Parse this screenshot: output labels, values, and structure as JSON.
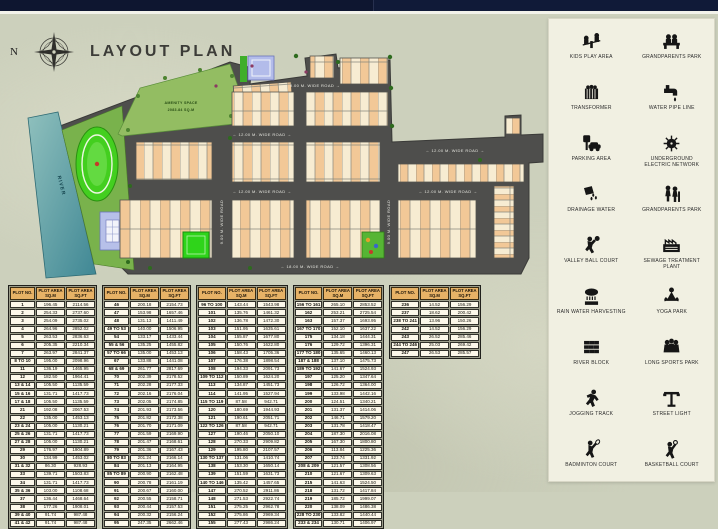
{
  "title": "LAYOUT PLAN",
  "compass": {
    "north_label": "N"
  },
  "map": {
    "labels": {
      "river": "RIVER",
      "amenity_line1": "AMENITY SPACE",
      "amenity_line2": "2083.84 SQ.M"
    },
    "road_labels": [
      "← 9.00 M. WIDE ROAD →",
      "← 12.00 M. WIDE ROAD →",
      "← 12.00 M. WIDE ROAD →",
      "← 12.00 M. WIDE ROAD →",
      "← 12.00 M. WIDE ROAD →",
      "← 18.00 M. WIDE ROAD →",
      "9.00 M. WIDE ROAD",
      "9.00 M. WIDE ROAD"
    ],
    "colors": {
      "road": "#4e4e4c",
      "plot_peach": "#f2c897",
      "plot_cream": "#f7ecd2",
      "park_green": "#79b24c",
      "track_green": "#43cf1f",
      "river_teal": "#5fa3ab",
      "building_blue": "#b7c0e9"
    }
  },
  "tables": {
    "headers": [
      "PLOT NO.",
      "PLOT AREA SQ.M",
      "PLOT AREA SQ.FT"
    ],
    "list": [
      {
        "rows": [
          [
            "1",
            "196.45",
            "2114.56"
          ],
          [
            "2",
            "254.33",
            "2737.60"
          ],
          [
            "3",
            "254.09",
            "2735.02"
          ],
          [
            "4",
            "264.96",
            "2852.02"
          ],
          [
            "5",
            "263.53",
            "2836.63"
          ],
          [
            "6",
            "205.35",
            "2210.34"
          ],
          [
            "7",
            "263.97",
            "2841.37"
          ],
          [
            "8 TO 10",
            "195.00",
            "2098.96"
          ],
          [
            "11",
            "136.19",
            "1465.95"
          ],
          [
            "12",
            "182.50",
            "1964.41"
          ],
          [
            "13 & 14",
            "105.50",
            "1135.59"
          ],
          [
            "15 & 16",
            "131.71",
            "1417.73"
          ],
          [
            "17 & 18",
            "105.50",
            "1135.59"
          ],
          [
            "21",
            "192.08",
            "2067.53"
          ],
          [
            "22",
            "135.00",
            "1453.13"
          ],
          [
            "23 & 24",
            "105.00",
            "1130.21"
          ],
          [
            "25 & 26",
            "131.71",
            "1417.73"
          ],
          [
            "27 & 28",
            "105.00",
            "1130.21"
          ],
          [
            "29",
            "176.97",
            "1904.89"
          ],
          [
            "30",
            "134.99",
            "1453.02"
          ],
          [
            "31 & 32",
            "86.30",
            "928.93"
          ],
          [
            "33",
            "139.71",
            "1503.83"
          ],
          [
            "34",
            "131.71",
            "1417.73"
          ],
          [
            "35 & 36",
            "103.00",
            "1108.68"
          ],
          [
            "37",
            "136.44",
            "1468.64"
          ],
          [
            "38",
            "177.26",
            "1908.01"
          ],
          [
            "39 & 40",
            "91.74",
            "987.48"
          ],
          [
            "41 & 42",
            "91.74",
            "987.48"
          ]
        ]
      },
      {
        "rows": [
          [
            "46",
            "200.18",
            "2154.73"
          ],
          [
            "47",
            "153.98",
            "1657.46"
          ],
          [
            "48",
            "131.13",
            "1411.49"
          ],
          [
            "49 TO 53",
            "140.00",
            "1506.95"
          ],
          [
            "54",
            "133.17",
            "1433.44"
          ],
          [
            "55 & 56",
            "135.25",
            "1455.82"
          ],
          [
            "57 TO 66",
            "135.00",
            "1453.13"
          ],
          [
            "67",
            "133.88",
            "1441.08"
          ],
          [
            "68 & 69",
            "261.77",
            "2817.69"
          ],
          [
            "70",
            "202.39",
            "2178.52"
          ],
          [
            "71",
            "202.28",
            "2177.33"
          ],
          [
            "72",
            "202.16",
            "2176.04"
          ],
          [
            "73",
            "202.05",
            "2174.85"
          ],
          [
            "74",
            "201.93",
            "2173.56"
          ],
          [
            "75",
            "201.82",
            "2172.38"
          ],
          [
            "76",
            "201.70",
            "2171.09"
          ],
          [
            "77",
            "201.59",
            "2169.90"
          ],
          [
            "78",
            "201.47",
            "2168.61"
          ],
          [
            "79",
            "201.36",
            "2167.43"
          ],
          [
            "80 TO 83",
            "201.24",
            "2166.14"
          ],
          [
            "84",
            "201.13",
            "2164.95"
          ],
          [
            "85 TO 89",
            "200.90",
            "2162.48"
          ],
          [
            "90",
            "200.78",
            "2161.19"
          ],
          [
            "91",
            "200.67",
            "2160.00"
          ],
          [
            "92",
            "200.55",
            "2158.71"
          ],
          [
            "93",
            "200.44",
            "2157.53"
          ],
          [
            "94",
            "200.32",
            "2156.24"
          ],
          [
            "95",
            "247.35",
            "2662.46"
          ]
        ]
      },
      {
        "rows": [
          [
            "96 TO 100",
            "143.44",
            "1543.98"
          ],
          [
            "101",
            "135.76",
            "1461.32"
          ],
          [
            "102",
            "136.78",
            "1472.30"
          ],
          [
            "103",
            "151.95",
            "1635.61"
          ],
          [
            "104",
            "155.87",
            "1677.80"
          ],
          [
            "105",
            "150.76",
            "1622.80"
          ],
          [
            "106",
            "158.43",
            "1705.36"
          ],
          [
            "107",
            "176.38",
            "1898.54"
          ],
          [
            "108",
            "194.33",
            "2091.73"
          ],
          [
            "109 TO 112",
            "150.89",
            "1624.20"
          ],
          [
            "113",
            "134.87",
            "1451.73"
          ],
          [
            "114",
            "141.95",
            "1527.94"
          ],
          [
            "115 TO 119",
            "87.58",
            "942.71"
          ],
          [
            "120",
            "180.69",
            "1944.93"
          ],
          [
            "121",
            "190.61",
            "2051.71"
          ],
          [
            "122 TO 126",
            "87.58",
            "942.71"
          ],
          [
            "127",
            "190.46",
            "2050.10"
          ],
          [
            "128",
            "270.33",
            "2909.82"
          ],
          [
            "129",
            "195.80",
            "2107.57"
          ],
          [
            "130 TO 137",
            "131.06",
            "1410.74"
          ],
          [
            "138",
            "153.30",
            "1650.14"
          ],
          [
            "139",
            "151.59",
            "1631.73"
          ],
          [
            "140 TO 146",
            "135.42",
            "1457.65"
          ],
          [
            "147",
            "270.52",
            "2911.86"
          ],
          [
            "148",
            "271.53",
            "2922.74"
          ],
          [
            "151",
            "275.25",
            "2962.78"
          ],
          [
            "152",
            "275.86",
            "2969.34"
          ],
          [
            "155",
            "277.43",
            "2986.24"
          ]
        ]
      },
      {
        "rows": [
          [
            "156 TO 161",
            "265.10",
            "2853.52"
          ],
          [
            "162",
            "253.21",
            "2725.54"
          ],
          [
            "163",
            "157.37",
            "1693.95"
          ],
          [
            "167 TO 170",
            "152.10",
            "1637.22"
          ],
          [
            "175",
            "134.18",
            "1444.31"
          ],
          [
            "176",
            "129.72",
            "1396.31"
          ],
          [
            "177 TO 180",
            "135.65",
            "1460.13"
          ],
          [
            "187 & 188",
            "137.10",
            "1475.73"
          ],
          [
            "189 TO 192",
            "141.67",
            "1524.93"
          ],
          [
            "197",
            "125.20",
            "1347.64"
          ],
          [
            "198",
            "126.72",
            "1364.00"
          ],
          [
            "199",
            "133.98",
            "1442.16"
          ],
          [
            "200",
            "124.51",
            "1340.21"
          ],
          [
            "201",
            "131.37",
            "1414.06"
          ],
          [
            "202",
            "146.71",
            "1579.20"
          ],
          [
            "203",
            "131.78",
            "1418.47"
          ],
          [
            "204",
            "187.30",
            "2016.08"
          ],
          [
            "205",
            "167.30",
            "1800.80"
          ],
          [
            "206",
            "113.84",
            "1225.36"
          ],
          [
            "207",
            "123.74",
            "1331.92"
          ],
          [
            "208 & 209",
            "121.57",
            "1308.56"
          ],
          [
            "210",
            "121.67",
            "1309.63"
          ],
          [
            "215",
            "141.63",
            "1524.50"
          ],
          [
            "218",
            "131.72",
            "1417.84"
          ],
          [
            "219",
            "185.72",
            "1999.07"
          ],
          [
            "220",
            "138.09",
            "1486.38"
          ],
          [
            "228 TO 230",
            "133.82",
            "1440.44"
          ],
          [
            "233 & 234",
            "130.71",
            "1406.97"
          ]
        ]
      },
      {
        "rows": [
          [
            "236",
            "14.52",
            "156.29"
          ],
          [
            "237",
            "18.62",
            "200.42"
          ],
          [
            "238 TO 241",
            "13.96",
            "150.26"
          ],
          [
            "242",
            "14.52",
            "156.29"
          ],
          [
            "243",
            "26.52",
            "285.46"
          ],
          [
            "244 TO 246",
            "25.03",
            "269.42"
          ],
          [
            "247",
            "26.53",
            "285.57"
          ]
        ]
      }
    ]
  },
  "legend": {
    "items": [
      {
        "icon": "kids-play-area-icon",
        "label": "KIDS PLAY AREA"
      },
      {
        "icon": "grandparents-park-icon",
        "label": "GRANDPARENTS PARK"
      },
      {
        "icon": "transformer-icon",
        "label": "TRANSFORMER"
      },
      {
        "icon": "water-pipe-line-icon",
        "label": "WATER PIPE LINE"
      },
      {
        "icon": "parking-area-icon",
        "label": "PARKING AREA"
      },
      {
        "icon": "underground-electric-network-icon",
        "label": "UNDERGROUND ELECTRIC NETWORK"
      },
      {
        "icon": "drainage-water-icon",
        "label": "DRAINAGE WATER"
      },
      {
        "icon": "grandparents-park-2-icon",
        "label": "GRANDPARENTS PARK"
      },
      {
        "icon": "valley-ball-court-icon",
        "label": "VALLEY BALL COURT"
      },
      {
        "icon": "sewage-treatment-plant-icon",
        "label": "SEWAGE TREATMENT PLANT"
      },
      {
        "icon": "rain-water-harvesting-icon",
        "label": "RAIN WATER HARVESTING"
      },
      {
        "icon": "yoga-park-icon",
        "label": "YOGA PARK"
      },
      {
        "icon": "river-block-icon",
        "label": "RIVER BLOCK"
      },
      {
        "icon": "long-sports-park-icon",
        "label": "LONG SPORTS PARK"
      },
      {
        "icon": "jogging-track-icon",
        "label": "JOGGING TRACK"
      },
      {
        "icon": "street-light-icon",
        "label": "STREET LIGHT"
      },
      {
        "icon": "badminton-court-icon",
        "label": "BADMINTON COURT"
      },
      {
        "icon": "basketball-court-icon",
        "label": "BASKETBALL COURT"
      }
    ]
  }
}
